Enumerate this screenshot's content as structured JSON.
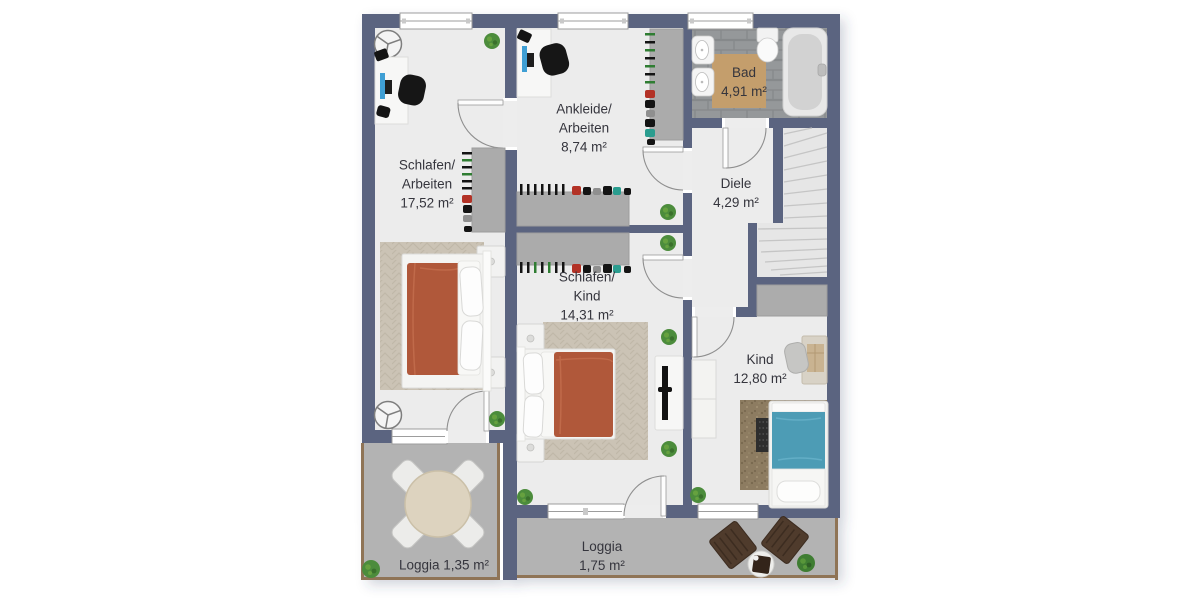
{
  "plan": {
    "title": "Obergeschoss Grundriss (floor plan)",
    "rooms": [
      {
        "id": "schlafen-arbeiten",
        "lines": [
          "Schlafen/",
          "Arbeiten",
          "17,52 m²"
        ]
      },
      {
        "id": "ankleide-arbeiten",
        "lines": [
          "Ankleide/",
          "Arbeiten",
          "8,74 m²"
        ]
      },
      {
        "id": "bad",
        "lines": [
          "Bad",
          "4,91 m²"
        ]
      },
      {
        "id": "diele",
        "lines": [
          "Diele",
          "4,29 m²"
        ]
      },
      {
        "id": "schlafen-kind",
        "lines": [
          "Schlafen/",
          "Kind",
          "14,31 m²"
        ]
      },
      {
        "id": "kind",
        "lines": [
          "Kind",
          "12,80 m²"
        ]
      },
      {
        "id": "loggia-left",
        "lines": [
          "Loggia 1,35 m²"
        ]
      },
      {
        "id": "loggia-bottom",
        "lines": [
          "Loggia",
          "1,75 m²"
        ]
      }
    ],
    "colors": {
      "wall": "#5b6480",
      "floor": "#ececec",
      "bath_tile": "#95989a",
      "bath_mat": "#c49e6c",
      "loggia_floor": "#b3b3b3",
      "wood_trim": "#8f7456",
      "rug_beige": "#cbc3b5",
      "rug_kid": "#8d7c61",
      "bed_blanket_terracotta": "#b0583a",
      "kid_bed_teal": "#4d9cb5",
      "furniture_grey": "#ababab",
      "plant_green": "#4c8c3c",
      "office_chair_black": "#161616",
      "lounge_chair_brown": "#4f3b2c",
      "label_text": "#35353d"
    },
    "icons": [
      "double-bed-icon",
      "single-bed-icon",
      "nightstand-icon",
      "desk-icon",
      "office-chair-icon",
      "monitor-icon",
      "wardrobe-icon",
      "clothes-rail-icon",
      "tv-sideboard-icon",
      "tv-icon",
      "bathtub-icon",
      "toilet-icon",
      "washbasin-icon",
      "bath-mat-icon",
      "staircase-icon",
      "ceiling-light-icon",
      "round-table-icon",
      "dining-chair-icon",
      "lounge-chair-icon",
      "side-table-icon",
      "plant-icon",
      "door-swing-icon",
      "window-icon"
    ]
  }
}
